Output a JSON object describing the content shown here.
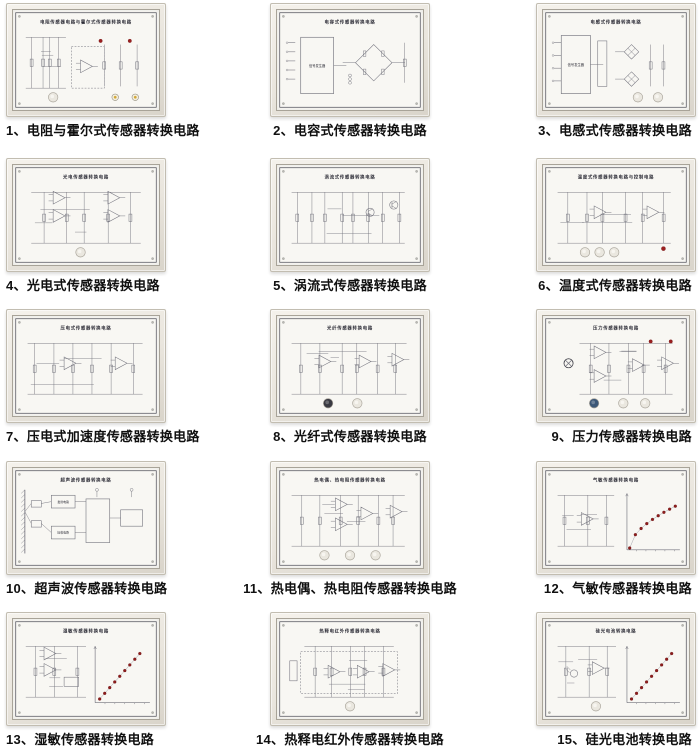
{
  "page": {
    "background_color": "#ffffff",
    "caption_color": "#101010",
    "description": "catalog of 15 sensor converter circuit training boards"
  },
  "colors": {
    "led_red": "#9c1f1f",
    "dot_red": "#8e1c1c",
    "knob_light": "#eae7df",
    "knob_dark": "#3a3a42",
    "knob_blue": "#3d5878",
    "terminal_yellow": "#d2a83a",
    "line": "#72727c",
    "printed_border": "#50505a",
    "title_text": "#2e2e38"
  },
  "panels": [
    {
      "num": "1",
      "caption": "1、电阻与霍尔式传感器转换电路",
      "board_title": "电阻传感器电路与霍尔式传感器转换电路"
    },
    {
      "num": "2",
      "caption": "2、电容式传感器转换电路",
      "board_title": "电容式传感器转换电路",
      "block_label": "信号发生器"
    },
    {
      "num": "3",
      "caption": "3、电感式传感器转换电路",
      "board_title": "电感式传感器转换电路",
      "block_label": "信号发生器"
    },
    {
      "num": "4",
      "caption": "4、光电式传感器转换电路",
      "board_title": "光电传感器转换电路"
    },
    {
      "num": "5",
      "caption": "5、涡流式传感器转换电路",
      "board_title": "涡流式传感器转换电路"
    },
    {
      "num": "6",
      "caption": "6、温度式传感器转换电路",
      "board_title": "温度式传感器转换电路与控制电路"
    },
    {
      "num": "7",
      "caption": "7、压电式加速度传感器转换电路",
      "board_title": "压电式传感器转换电路"
    },
    {
      "num": "8",
      "caption": "8、光纤式传感器转换电路",
      "board_title": "光纤传感器转换电路"
    },
    {
      "num": "9",
      "caption": "9、压力传感器转换电路",
      "board_title": "压力传感器转换电路"
    },
    {
      "num": "10",
      "caption": "10、超声波传感器转换电路",
      "board_title": "超声波传感器转换电路",
      "block_labels": [
        "发射电路",
        "接收电路"
      ]
    },
    {
      "num": "11",
      "caption": "11、热电偶、热电阻传感器转换电路",
      "board_title": "热电偶、热电阻传感器转换电路"
    },
    {
      "num": "12",
      "caption": "12、气敏传感器转换电路",
      "board_title": "气敏传感器转换电路"
    },
    {
      "num": "13",
      "caption": "13、湿敏传感器转换电路",
      "board_title": "湿敏传感器转换电路"
    },
    {
      "num": "14",
      "caption": "14、热释电红外传感器转换电路",
      "board_title": "热释电红外传感器转换电路"
    },
    {
      "num": "15",
      "caption": "15、硅光电池转换电路",
      "board_title": "硅光电池转换电路"
    }
  ]
}
